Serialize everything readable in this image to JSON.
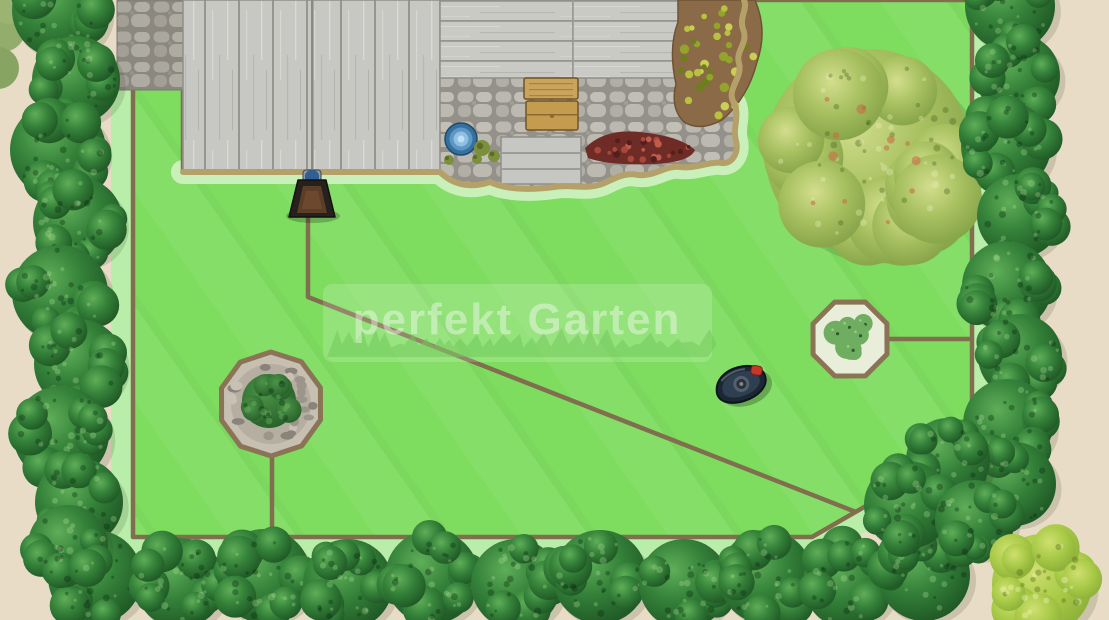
{
  "watermark": {
    "text": "perfekt Garten"
  },
  "scene": {
    "description": "Top-down garden plan showing a robotic lawn mower, its charging station and the boundary-wire layout around lawn, terrace and flower islands",
    "elements": [
      {
        "name": "lawn",
        "label": "Lawn"
      },
      {
        "name": "boundary-wire",
        "label": "Boundary wire"
      },
      {
        "name": "robot-mower",
        "label": "Robotic lawn mower"
      },
      {
        "name": "charging-station",
        "label": "Charging station"
      },
      {
        "name": "wooden-terrace",
        "label": "Wooden terrace"
      },
      {
        "name": "stone-patio",
        "label": "Stone patio"
      },
      {
        "name": "terrace-steps",
        "label": "Terrace steps"
      },
      {
        "name": "pond",
        "label": "Small pond"
      },
      {
        "name": "large-shrub",
        "label": "Large shrub"
      },
      {
        "name": "flower-island-left",
        "label": "Stone flower island"
      },
      {
        "name": "flower-island-right",
        "label": "Flower island"
      },
      {
        "name": "hedge",
        "label": "Hedge bushes"
      },
      {
        "name": "corner-bush",
        "label": "Yellow-green corner bush"
      }
    ]
  },
  "colors": {
    "ground": "#e8dcc6",
    "lawn": "#7edc5f",
    "lawn_margin": "#b9edaa",
    "patio_margin": "#cdf0bf",
    "wire": "#806e4e",
    "edging": "#b4a169",
    "deck": "#c7c7c3",
    "hedge_dark": "#1c5222",
    "hedge_light": "#5fae58",
    "mower_red": "#c43a2a",
    "station_blue": "#2f5f93"
  }
}
